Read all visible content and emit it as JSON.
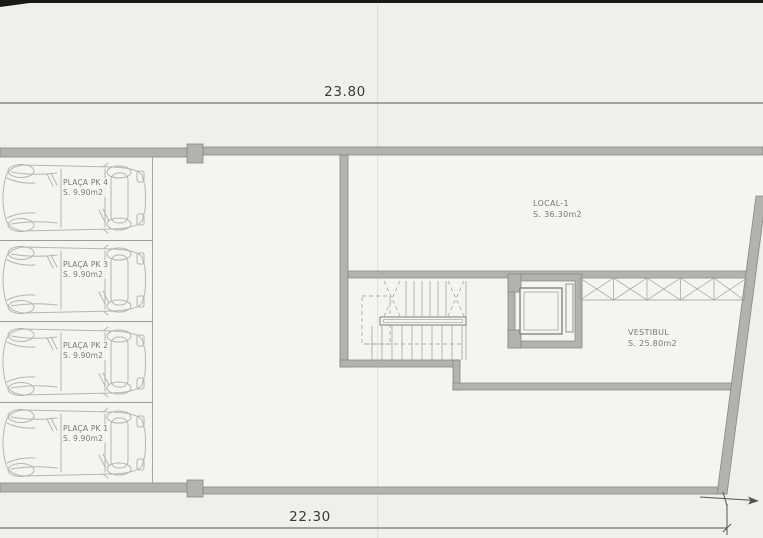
{
  "sheet": {
    "dimensions": {
      "top": "23.80",
      "bottom": "22.30"
    },
    "parking_stalls": [
      {
        "label": "PLAÇA PK 4",
        "area": "S. 9.90m2"
      },
      {
        "label": "PLAÇA PK 3",
        "area": "S. 9.90m2"
      },
      {
        "label": "PLAÇA PK 2",
        "area": "S. 9.90m2"
      },
      {
        "label": "PLAÇA PK 1",
        "area": "S. 9.90m2"
      }
    ],
    "rooms": {
      "local": {
        "name": "LOCAL-1",
        "area": "S. 36.30m2"
      },
      "vestibule": {
        "name": "VESTIBUL",
        "area": "S. 25.80m2"
      }
    },
    "colors": {
      "paper": "#f0efec",
      "paper_light": "#f5f4f1",
      "wall_fill": "#b3b2af",
      "wall_edge": "#898884",
      "line": "#9c9b98",
      "car_line": "#b6b5b2",
      "text": "#7a7976",
      "dim_text": "#3c3b39"
    }
  }
}
